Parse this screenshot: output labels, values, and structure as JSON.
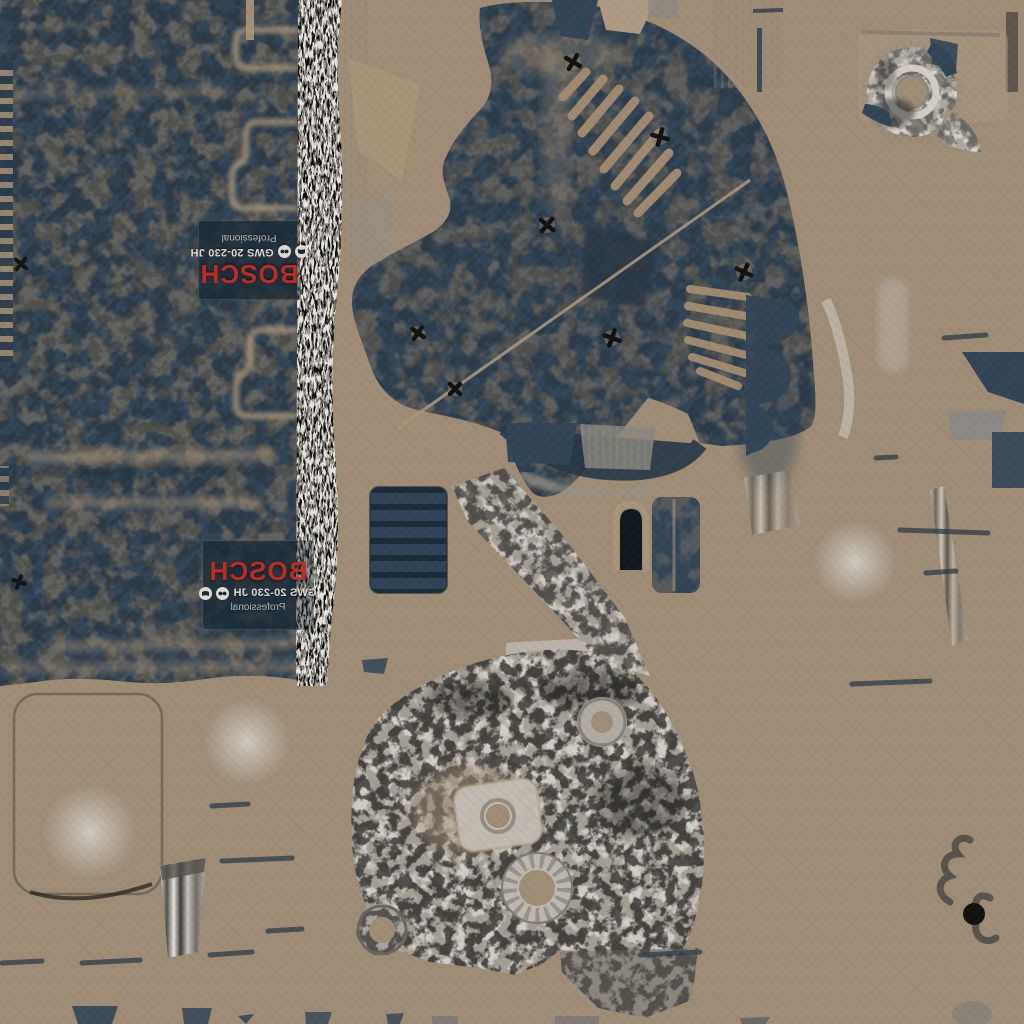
{
  "labels": {
    "brand": "BOSCH",
    "model": "GWS 20-230 JH",
    "series": "Professional"
  },
  "icons": [
    {
      "name": "read-manual-icon"
    },
    {
      "name": "safety-goggles-icon"
    }
  ],
  "colors": {
    "background": "#a5917a",
    "navy": "#33475a",
    "navy_dark": "#29394a",
    "plate_navy": "#2c4053",
    "bosch_red": "#bb2d23",
    "label_text": "#ddd8d0",
    "tan_seam": "#b29b80",
    "metal_gray": "#a39e95",
    "metal_light": "#c9c4bb",
    "noise_dark": "#1a1a1a"
  }
}
